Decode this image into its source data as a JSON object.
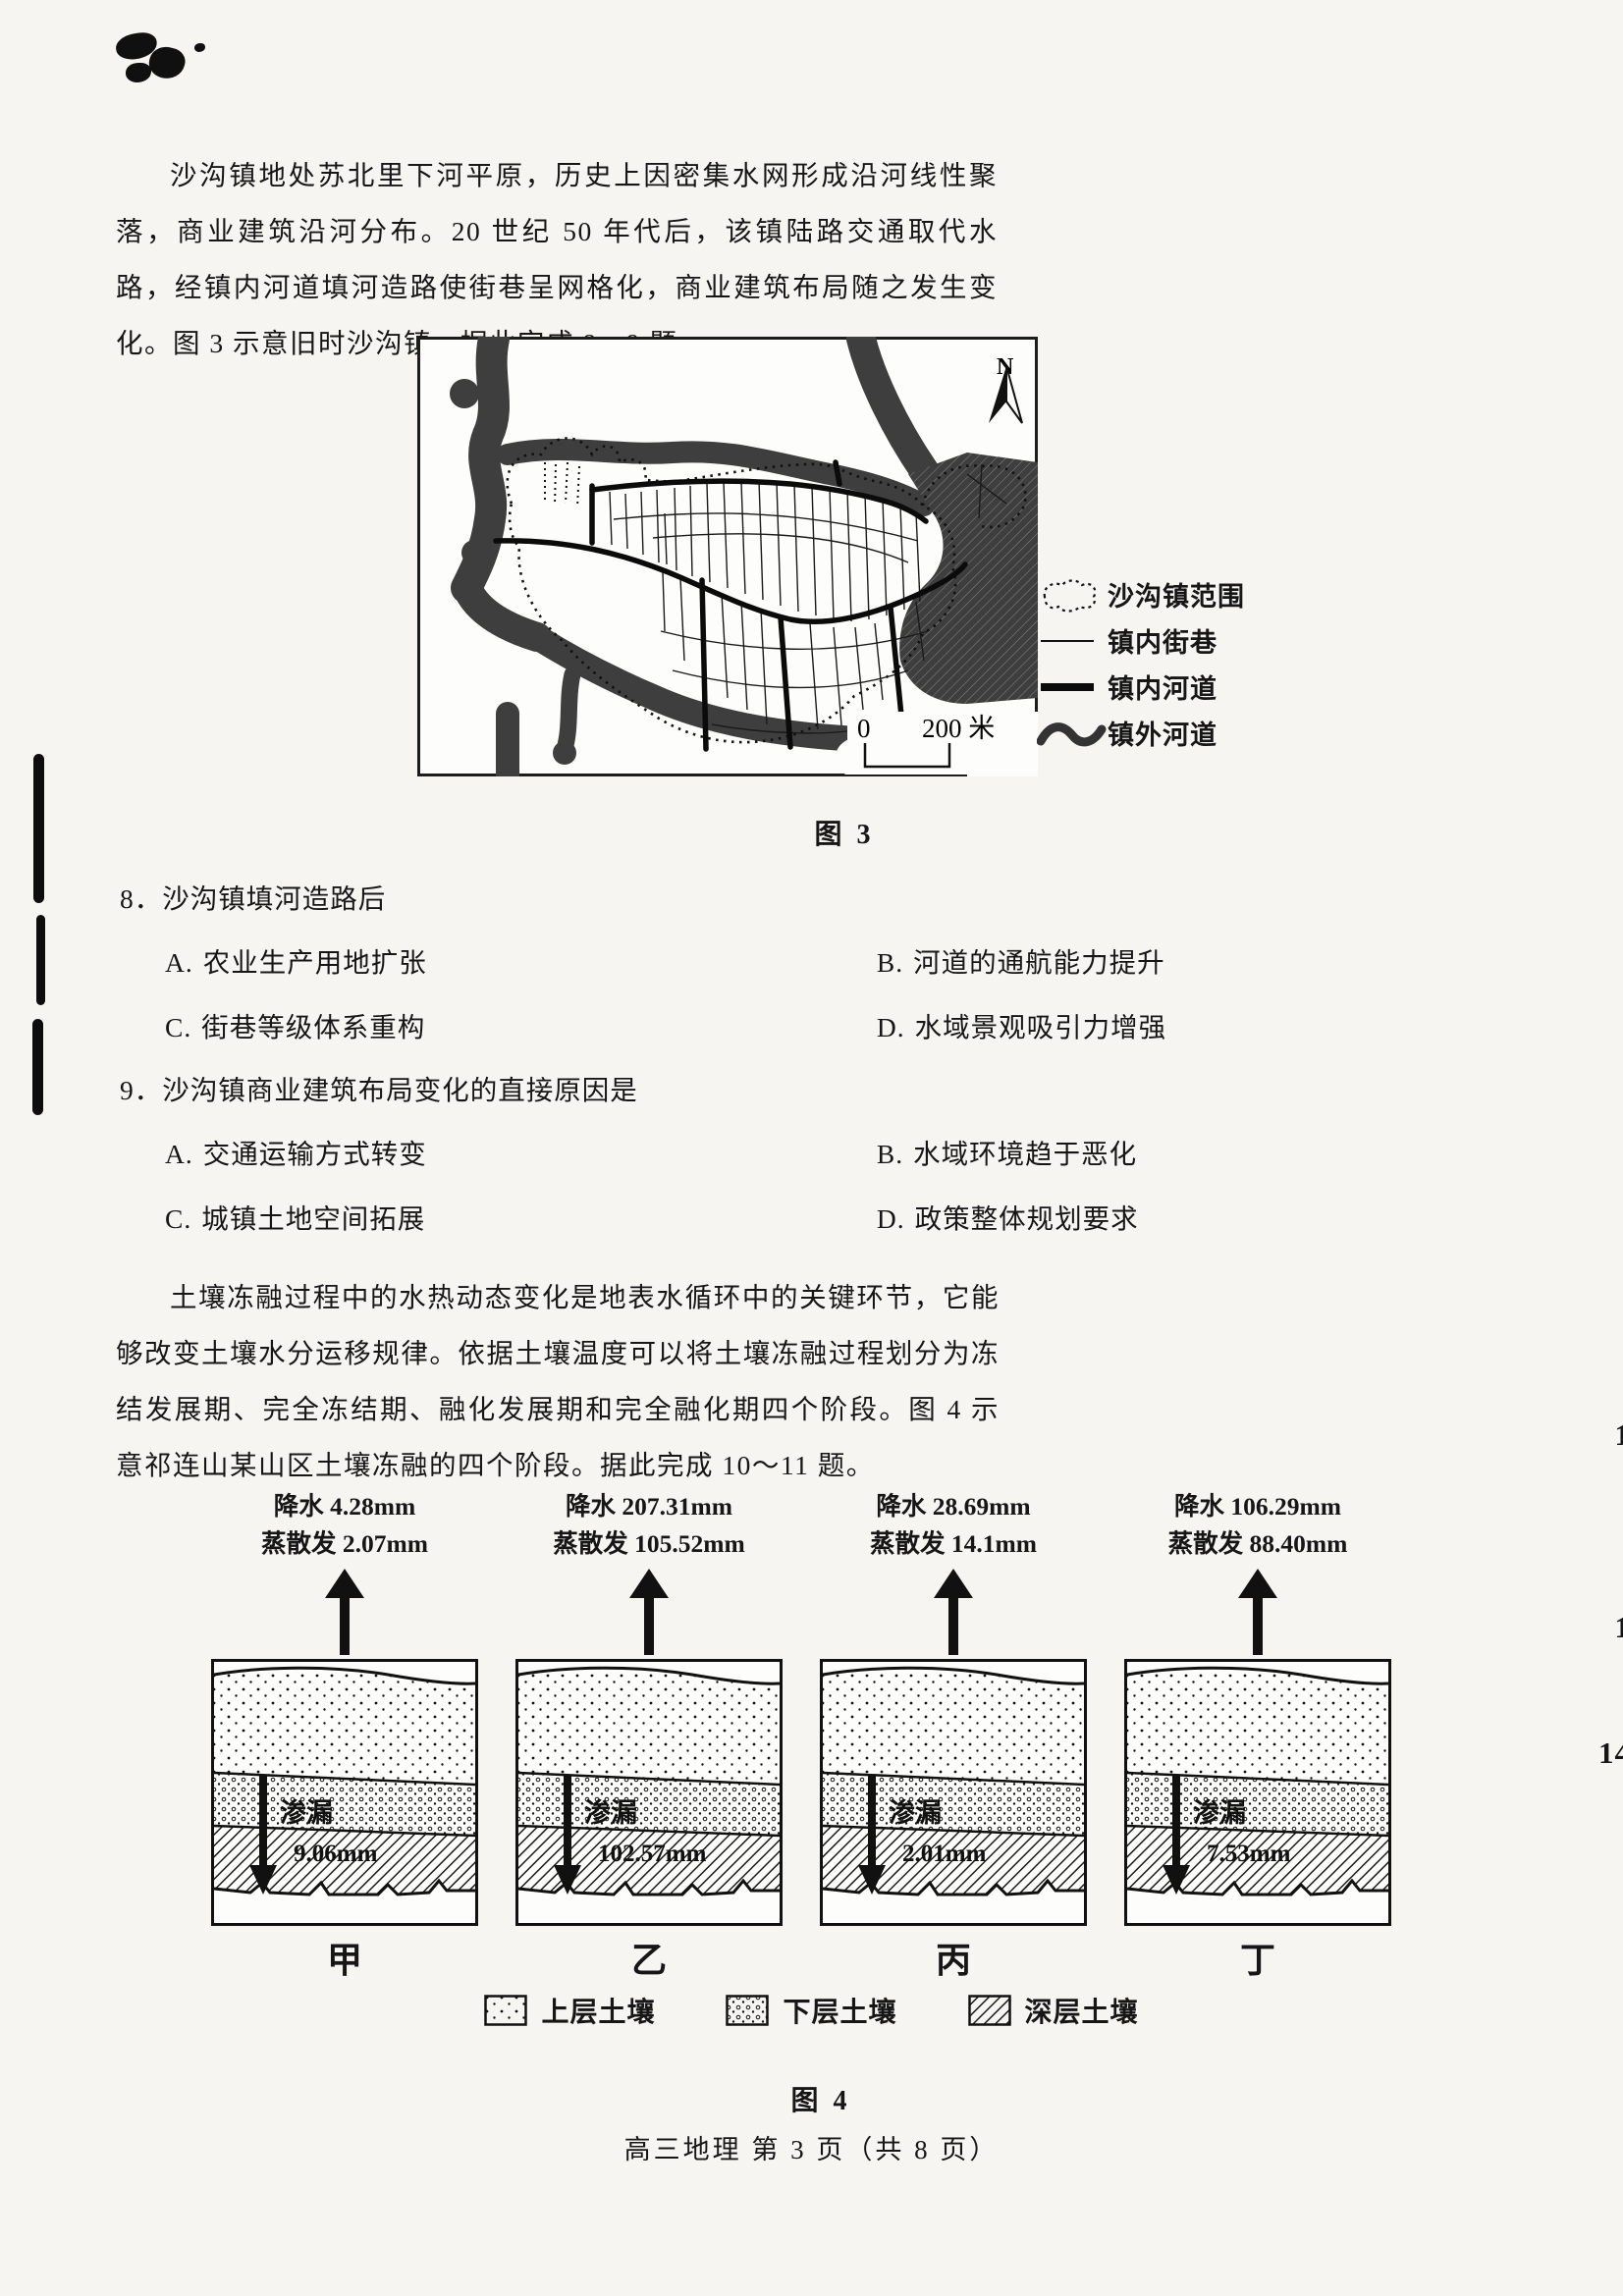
{
  "passage1": {
    "text": "沙沟镇地处苏北里下河平原，历史上因密集水网形成沿河线性聚落，商业建筑沿河分布。20 世纪 50 年代后，该镇陆路交通取代水路，经镇内河道填河造路使街巷呈网格化，商业建筑布局随之发生变化。图 3 示意旧时沙沟镇。据此完成 8～9 题。"
  },
  "fig3": {
    "caption": "图 3",
    "north": "N",
    "scale_zero": "0",
    "scale_label": "200 米",
    "legend": [
      {
        "label": "沙沟镇范围"
      },
      {
        "label": "镇内街巷"
      },
      {
        "label": "镇内河道"
      },
      {
        "label": "镇外河道"
      }
    ]
  },
  "q8": {
    "stem": "8．沙沟镇填河造路后",
    "options": [
      {
        "key": "A.",
        "text": "农业生产用地扩张"
      },
      {
        "key": "B.",
        "text": "河道的通航能力提升"
      },
      {
        "key": "C.",
        "text": "街巷等级体系重构"
      },
      {
        "key": "D.",
        "text": "水域景观吸引力增强"
      }
    ]
  },
  "q9": {
    "stem": "9．沙沟镇商业建筑布局变化的直接原因是",
    "options": [
      {
        "key": "A.",
        "text": "交通运输方式转变"
      },
      {
        "key": "B.",
        "text": "水域环境趋于恶化"
      },
      {
        "key": "C.",
        "text": "城镇土地空间拓展"
      },
      {
        "key": "D.",
        "text": "政策整体规划要求"
      }
    ]
  },
  "passage2": {
    "text": "土壤冻融过程中的水热动态变化是地表水循环中的关键环节，它能够改变土壤水分运移规律。依据土壤温度可以将土壤冻融过程划分为冻结发展期、完全冻结期、融化发展期和完全融化期四个阶段。图 4 示意祁连山某山区土壤冻融的四个阶段。据此完成 10～11 题。"
  },
  "fig4": {
    "caption": "图 4",
    "columns": [
      {
        "precip": "降水 4.28mm",
        "evap": "蒸散发 2.07mm",
        "seep_label": "渗漏",
        "seep_value": "9.06mm",
        "name": "甲"
      },
      {
        "precip": "降水 207.31mm",
        "evap": "蒸散发 105.52mm",
        "seep_label": "渗漏",
        "seep_value": "102.57mm",
        "name": "乙"
      },
      {
        "precip": "降水 28.69mm",
        "evap": "蒸散发 14.1mm",
        "seep_label": "渗漏",
        "seep_value": "2.01mm",
        "name": "丙"
      },
      {
        "precip": "降水 106.29mm",
        "evap": "蒸散发 88.40mm",
        "seep_label": "渗漏",
        "seep_value": "7.53mm",
        "name": "丁"
      }
    ],
    "legend": [
      {
        "label": "上层土壤"
      },
      {
        "label": "下层土壤"
      },
      {
        "label": "深层土壤"
      }
    ]
  },
  "footer": {
    "text": "高三地理  第 3 页（共 8 页）"
  },
  "edge_numbers": {
    "n1": "1",
    "n2": "1",
    "n3": "14"
  }
}
